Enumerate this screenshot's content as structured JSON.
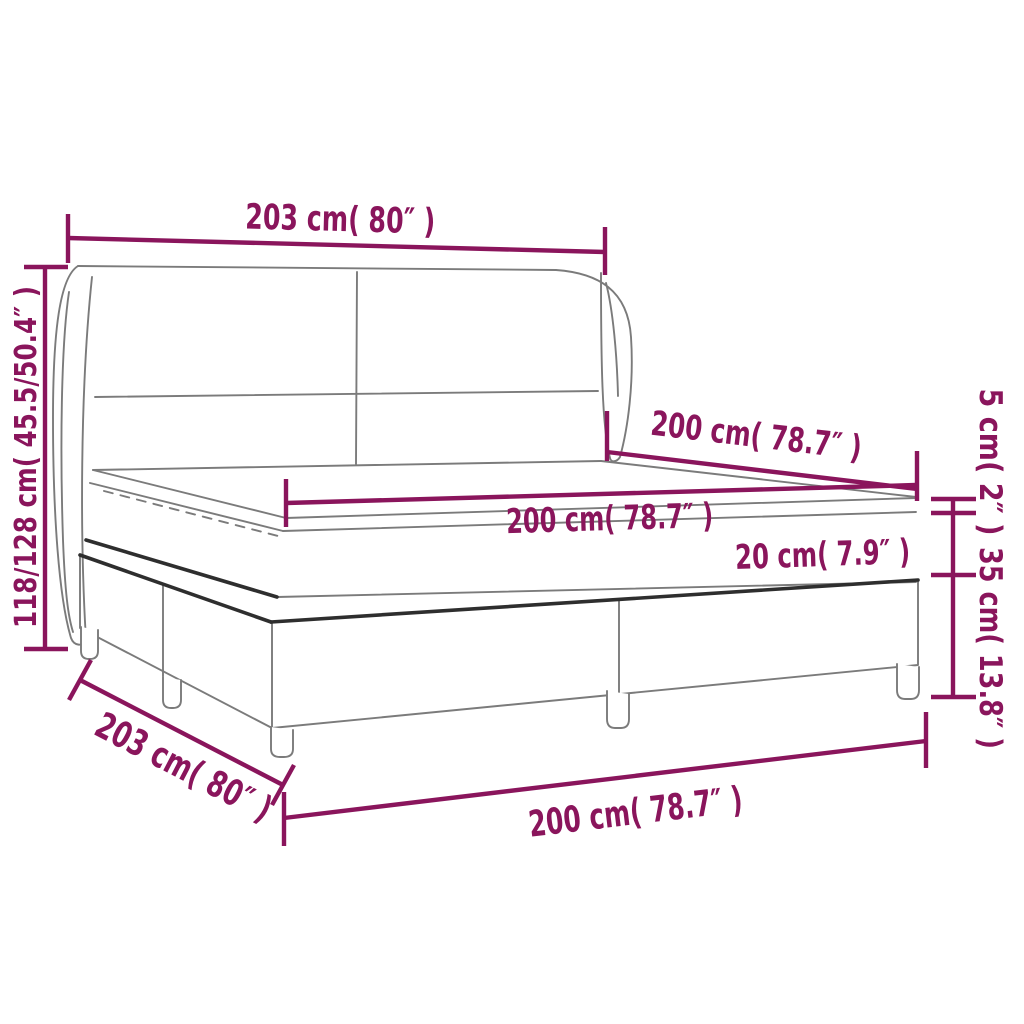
{
  "diagram": {
    "type": "product-dimension-diagram",
    "subject": "box spring bed with winged headboard, mattress and topper",
    "colors": {
      "accent": "#8A155C",
      "line": "#7b7b7b",
      "piping": "#2e2e2e",
      "background": "#ffffff"
    },
    "labels": {
      "frame_width_top": "203 cm( 80″ )",
      "headboard_height_left": "118/128 cm( 45.5/50.4″ )",
      "mattress_width_upper": "200 cm( 78.7″ )",
      "mattress_length_mid": "200 cm( 78.7″ )",
      "mattress_thickness": "20 cm( 7.9″ )",
      "topper_thickness_right": "5 cm( 2″ )",
      "base_height_right": "35 cm( 13.8″ )",
      "frame_depth_diagonal": "203 cm( 80″ )",
      "bed_length_bottom": "200 cm( 78.7″ )"
    }
  }
}
